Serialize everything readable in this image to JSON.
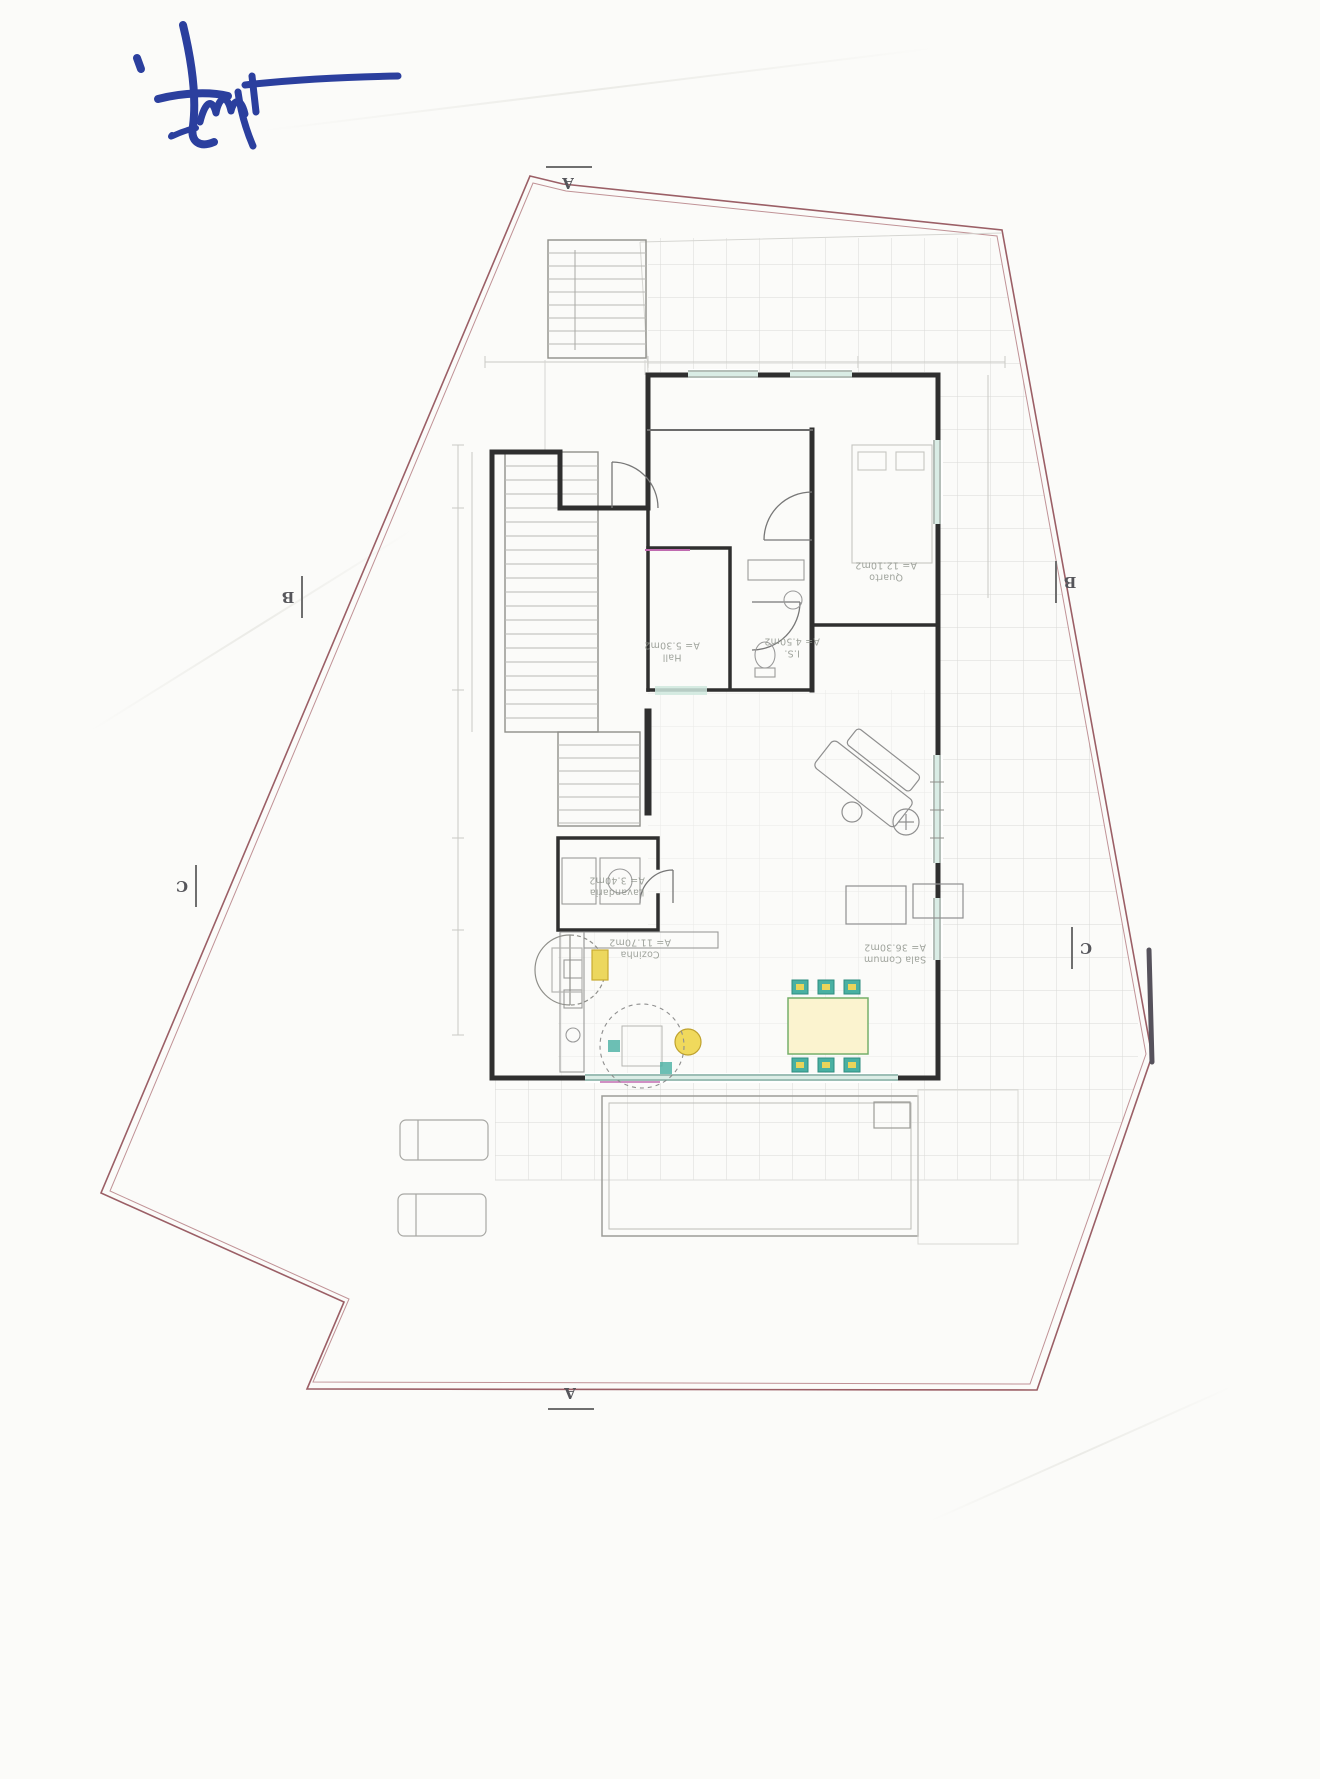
{
  "signature": {
    "ink_color": "#2b3f9e",
    "description": "handwritten-initials-blue-pen"
  },
  "plan": {
    "rooms": [
      {
        "name": "Quarto",
        "area": "A= 12.10m2"
      },
      {
        "name": "Hall",
        "area": "A= 5.30m2"
      },
      {
        "name": "I.S.",
        "area": "A= 4.50m2"
      },
      {
        "name": "Lavandaria",
        "area": "A= 3.40m2"
      },
      {
        "name": "Cozinha",
        "area": "A= 11.70m2"
      },
      {
        "name": "Sala Comum",
        "area": "A= 36.30m2"
      }
    ],
    "section_markers": {
      "top": "A",
      "bottom": "A",
      "left_upper": "B",
      "left_lower": "C",
      "right_upper": "B",
      "right_lower": "C"
    },
    "colors": {
      "boundary_line": "#9b5f66",
      "wall_line": "#2f2f2f",
      "tile_grid": "#dadad6",
      "window_tint": "#cfe7de",
      "accent_magenta": "#c06bb0",
      "chair_teal": "#49b0a2",
      "table_green": "#76b06a",
      "accent_yellow": "#ead45a"
    }
  }
}
